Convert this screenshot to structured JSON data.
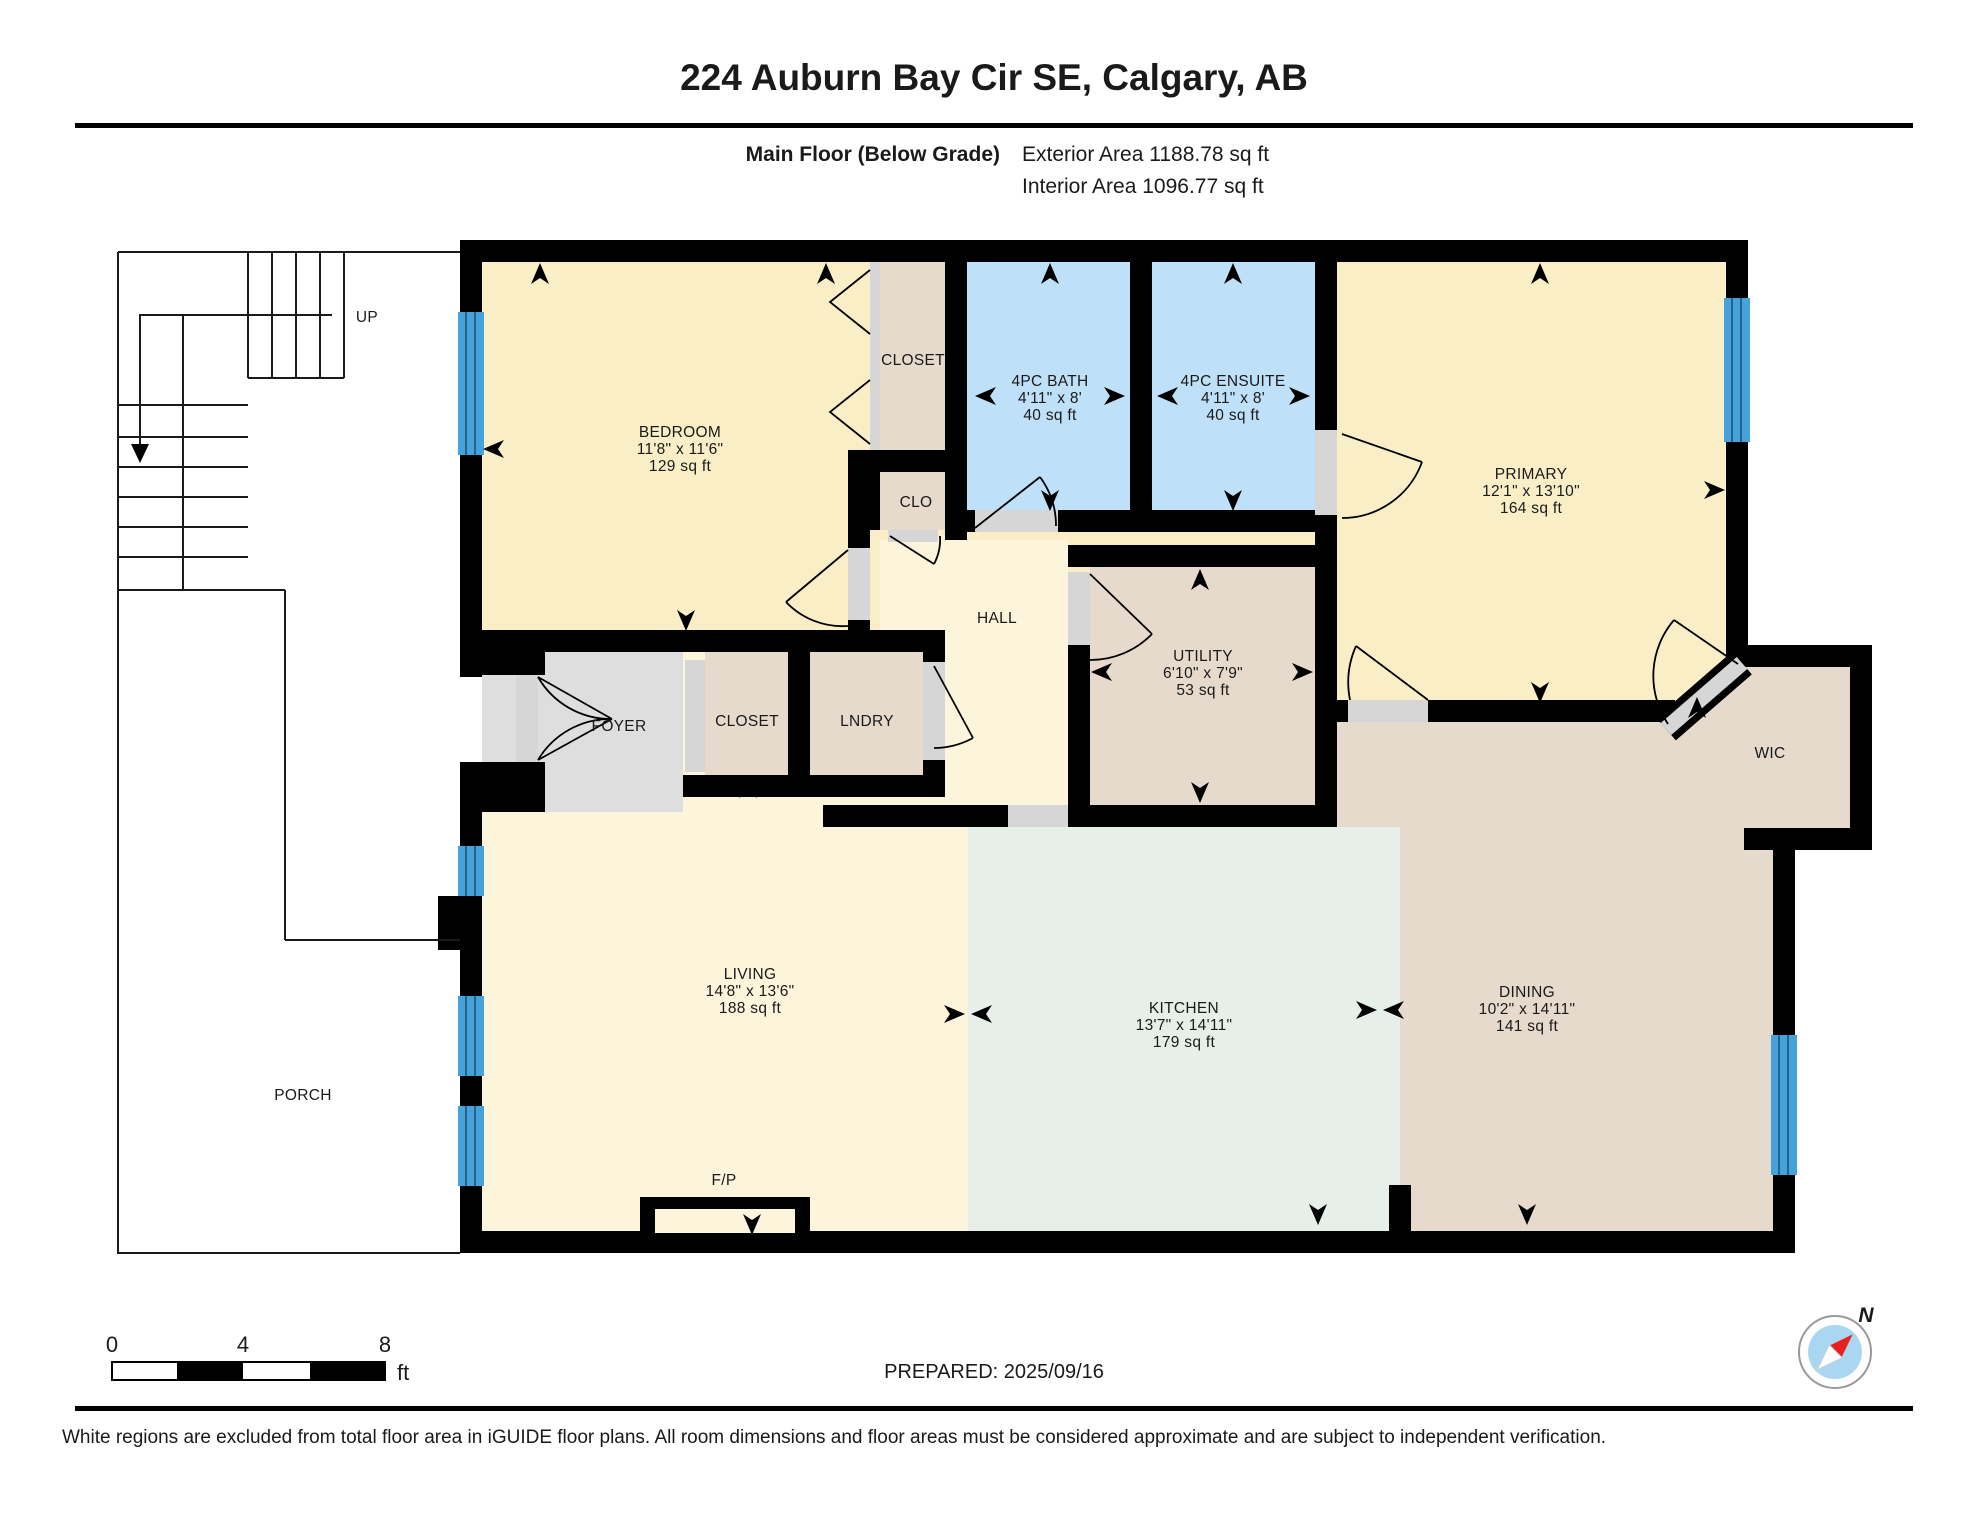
{
  "header": {
    "title": "224 Auburn Bay Cir SE, Calgary, AB",
    "floor_label": "Main Floor (Below Grade)",
    "exterior_area_label": "Exterior Area 1188.78 sq ft",
    "interior_area_label": "Interior Area 1096.77 sq ft"
  },
  "rooms": {
    "bedroom": {
      "name": "BEDROOM",
      "dims": "11'8\" x 11'6\"",
      "area": "129 sq ft"
    },
    "closet_top": {
      "name": "CLOSET"
    },
    "bath": {
      "name": "4PC BATH",
      "dims": "4'11\" x 8'",
      "area": "40 sq ft"
    },
    "ensuite": {
      "name": "4PC ENSUITE",
      "dims": "4'11\" x 8'",
      "area": "40 sq ft"
    },
    "primary": {
      "name": "PRIMARY",
      "dims": "12'1\" x 13'10\"",
      "area": "164 sq ft"
    },
    "clo": {
      "name": "CLO"
    },
    "hall": {
      "name": "HALL"
    },
    "utility": {
      "name": "UTILITY",
      "dims": "6'10\" x 7'9\"",
      "area": "53 sq ft"
    },
    "foyer": {
      "name": "FOYER"
    },
    "closet_mid": {
      "name": "CLOSET"
    },
    "lndry": {
      "name": "LNDRY"
    },
    "living": {
      "name": "LIVING",
      "dims": "14'8\" x 13'6\"",
      "area": "188 sq ft"
    },
    "kitchen": {
      "name": "KITCHEN",
      "dims": "13'7\" x 14'11\"",
      "area": "179 sq ft"
    },
    "dining": {
      "name": "DINING",
      "dims": "10'2\" x 14'11\"",
      "area": "141 sq ft"
    },
    "wic": {
      "name": "WIC"
    },
    "porch": {
      "name": "PORCH"
    },
    "fireplace": {
      "name": "F/P"
    }
  },
  "stairs": {
    "up_label": "UP"
  },
  "compass": {
    "north_label": "N"
  },
  "scale_bar": {
    "t0": "0",
    "t4": "4",
    "t8": "8",
    "unit": "ft"
  },
  "footer": {
    "prepared": "PREPARED: 2025/09/16",
    "disclaimer": "White regions are excluded from total floor area in iGUIDE floor plans. All room dimensions and floor areas must be considered approximate and are subject to independent verification."
  },
  "colors": {
    "wall": "#000000",
    "cream": "#F9EEC6",
    "cream_light": "#FCF4DB",
    "tan": "#E5DACC",
    "blue": "#BEE0F8",
    "mint": "#E6EFE8",
    "gray_room": "#DEDEDE",
    "threshold": "#D6D6D6",
    "window": "#44A3DA",
    "compass_red": "#E8211D",
    "compass_blue": "#A9D7F2"
  }
}
